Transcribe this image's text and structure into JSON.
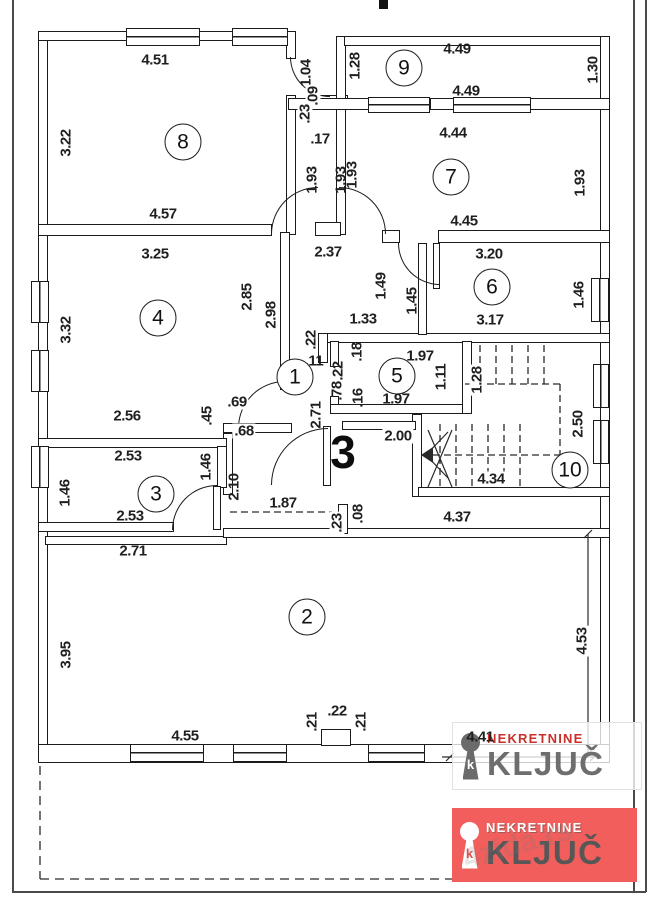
{
  "page": {
    "background": "#ffffff",
    "wall_color": "#1b1b1b",
    "frame_color": "#4a4a4a"
  },
  "plan": {
    "rooms": [
      {
        "n": "1",
        "x": 295,
        "y": 377
      },
      {
        "n": "2",
        "x": 307,
        "y": 617
      },
      {
        "n": "3",
        "x": 156,
        "y": 494
      },
      {
        "n": "4",
        "x": 158,
        "y": 318
      },
      {
        "n": "5",
        "x": 397,
        "y": 376
      },
      {
        "n": "6",
        "x": 492,
        "y": 287
      },
      {
        "n": "7",
        "x": 451,
        "y": 177
      },
      {
        "n": "8",
        "x": 183,
        "y": 142
      },
      {
        "n": "9",
        "x": 404,
        "y": 68
      },
      {
        "n": "10",
        "x": 570,
        "y": 470
      }
    ],
    "hall_label": {
      "t": "3",
      "x": 343,
      "y": 452
    },
    "dimensions": [
      {
        "t": "4.51",
        "x": 155,
        "y": 60
      },
      {
        "t": "3.22",
        "x": 66,
        "y": 143,
        "r": 1
      },
      {
        "t": "4.57",
        "x": 163,
        "y": 214
      },
      {
        "t": "1.04",
        "x": 306,
        "y": 73,
        "r": 1
      },
      {
        "t": ".09",
        "x": 313,
        "y": 96,
        "r": 1,
        "bg": 1
      },
      {
        "t": ".23",
        "x": 305,
        "y": 114,
        "r": 1,
        "bg": 1
      },
      {
        "t": ".17",
        "x": 320,
        "y": 139
      },
      {
        "t": "1.93",
        "x": 312,
        "y": 180,
        "r": 1
      },
      {
        "t": "1.93",
        "x": 341,
        "y": 180,
        "r": 1
      },
      {
        "t": "1.28",
        "x": 355,
        "y": 66,
        "r": 1
      },
      {
        "t": "4.49",
        "x": 457,
        "y": 49
      },
      {
        "t": "1.30",
        "x": 593,
        "y": 70,
        "r": 1
      },
      {
        "t": "4.49",
        "x": 466,
        "y": 91
      },
      {
        "t": "4.44",
        "x": 453,
        "y": 133
      },
      {
        "t": "1.93",
        "x": 352,
        "y": 175,
        "r": 1
      },
      {
        "t": "1.93",
        "x": 580,
        "y": 183,
        "r": 1
      },
      {
        "t": "4.45",
        "x": 464,
        "y": 221
      },
      {
        "t": "2.37",
        "x": 328,
        "y": 252
      },
      {
        "t": "3.25",
        "x": 155,
        "y": 254
      },
      {
        "t": "3.32",
        "x": 66,
        "y": 330,
        "r": 1
      },
      {
        "t": "2.85",
        "x": 247,
        "y": 297,
        "r": 1
      },
      {
        "t": "2.98",
        "x": 271,
        "y": 315,
        "r": 1
      },
      {
        "t": "2.56",
        "x": 127,
        "y": 416
      },
      {
        "t": ".45",
        "x": 207,
        "y": 416,
        "r": 1
      },
      {
        "t": ".69",
        "x": 237,
        "y": 402,
        "bg": 1
      },
      {
        "t": ".68",
        "x": 244,
        "y": 431,
        "bg": 1
      },
      {
        "t": ".22",
        "x": 311,
        "y": 340,
        "r": 1
      },
      {
        "t": ".11",
        "x": 314,
        "y": 361
      },
      {
        "t": "1.49",
        "x": 381,
        "y": 286,
        "r": 1
      },
      {
        "t": "1.45",
        "x": 412,
        "y": 301,
        "r": 1
      },
      {
        "t": "1.33",
        "x": 363,
        "y": 319
      },
      {
        "t": "3.20",
        "x": 489,
        "y": 254
      },
      {
        "t": "1.46",
        "x": 579,
        "y": 295,
        "r": 1
      },
      {
        "t": "3.17",
        "x": 490,
        "y": 320
      },
      {
        "t": ".18",
        "x": 357,
        "y": 352,
        "r": 1
      },
      {
        "t": ".22",
        "x": 338,
        "y": 371,
        "r": 1
      },
      {
        "t": ".78",
        "x": 337,
        "y": 391,
        "r": 1
      },
      {
        "t": ".16",
        "x": 358,
        "y": 398,
        "r": 1
      },
      {
        "t": "1.97",
        "x": 420,
        "y": 356
      },
      {
        "t": "1.11",
        "x": 441,
        "y": 377,
        "r": 1
      },
      {
        "t": "1.97",
        "x": 396,
        "y": 399
      },
      {
        "t": "2.71",
        "x": 316,
        "y": 415,
        "r": 1
      },
      {
        "t": "2.00",
        "x": 398,
        "y": 436,
        "bg": 1
      },
      {
        "t": "1.28",
        "x": 477,
        "y": 380,
        "r": 1,
        "bg": 1
      },
      {
        "t": "2.50",
        "x": 578,
        "y": 424,
        "r": 1
      },
      {
        "t": "4.34",
        "x": 491,
        "y": 479,
        "bg": 1
      },
      {
        "t": "2.53",
        "x": 128,
        "y": 456
      },
      {
        "t": "1.46",
        "x": 65,
        "y": 493,
        "r": 1
      },
      {
        "t": "1.46",
        "x": 206,
        "y": 467,
        "r": 1
      },
      {
        "t": "2.10",
        "x": 234,
        "y": 487,
        "r": 1
      },
      {
        "t": "2.53",
        "x": 130,
        "y": 516
      },
      {
        "t": "2.71",
        "x": 133,
        "y": 551
      },
      {
        "t": "1.87",
        "x": 283,
        "y": 503,
        "bg": 1
      },
      {
        "t": ".23",
        "x": 337,
        "y": 523,
        "r": 1,
        "bg": 1
      },
      {
        "t": ".08",
        "x": 358,
        "y": 514,
        "r": 1,
        "bg": 1
      },
      {
        "t": "4.37",
        "x": 457,
        "y": 517
      },
      {
        "t": "3.95",
        "x": 66,
        "y": 655,
        "r": 1
      },
      {
        "t": "4.55",
        "x": 185,
        "y": 736
      },
      {
        "t": ".21",
        "x": 312,
        "y": 722,
        "r": 1
      },
      {
        "t": ".22",
        "x": 337,
        "y": 711
      },
      {
        "t": ".21",
        "x": 361,
        "y": 722,
        "r": 1
      },
      {
        "t": "4.53",
        "x": 582,
        "y": 641,
        "r": 1,
        "bg": 1
      },
      {
        "t": "4.41",
        "x": 480,
        "y": 737
      }
    ]
  },
  "branding": {
    "watermark_badge": {
      "brand_top": "NEKRETNINE",
      "brand_main": "KLJUČ"
    },
    "footer_badge": {
      "brand_top": "NEKRETNINE",
      "brand_main": "KLJUČ"
    },
    "diagonal_watermark": "4zida.rs",
    "red": "#c9302c",
    "badge_bg_red": "#f15e5c",
    "gray": "#6e6e6e"
  }
}
